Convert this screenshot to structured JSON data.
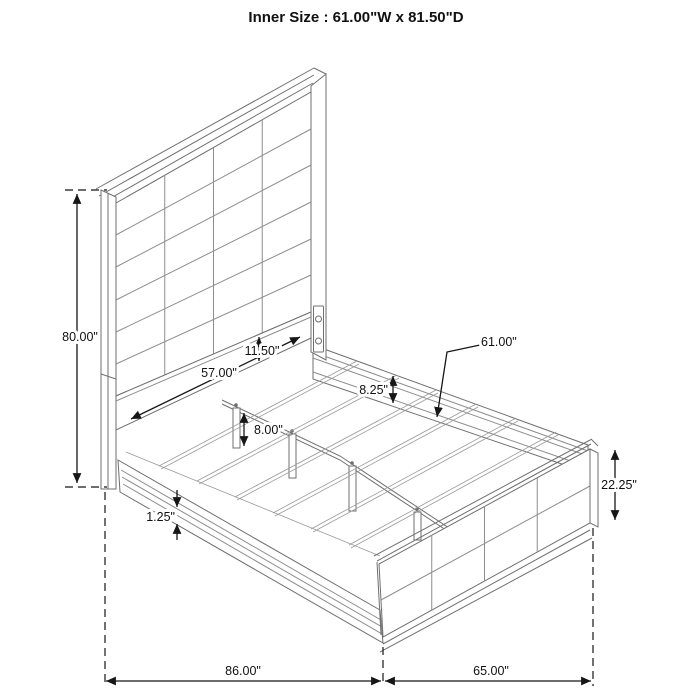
{
  "title": "Inner Size : 61.00\"W x 81.50\"D",
  "dimensions": {
    "headboard_height": {
      "label": "80.00\""
    },
    "headboard_inner_width": {
      "label": "57.00\""
    },
    "headboard_lower_panel": {
      "label": "11.50\""
    },
    "rail_depth": {
      "label": "8.25\""
    },
    "slat_length": {
      "label": "61.00\""
    },
    "support_leg_height": {
      "label": "8.00\""
    },
    "rail_lip": {
      "label": "1.25\""
    },
    "footboard_height": {
      "label": "22.25\""
    },
    "overall_depth": {
      "label": "86.00\""
    },
    "overall_width": {
      "label": "65.00\""
    }
  },
  "colors": {
    "line_art": "#6f6f6f",
    "dimension": "#161616",
    "background": "#ffffff"
  }
}
